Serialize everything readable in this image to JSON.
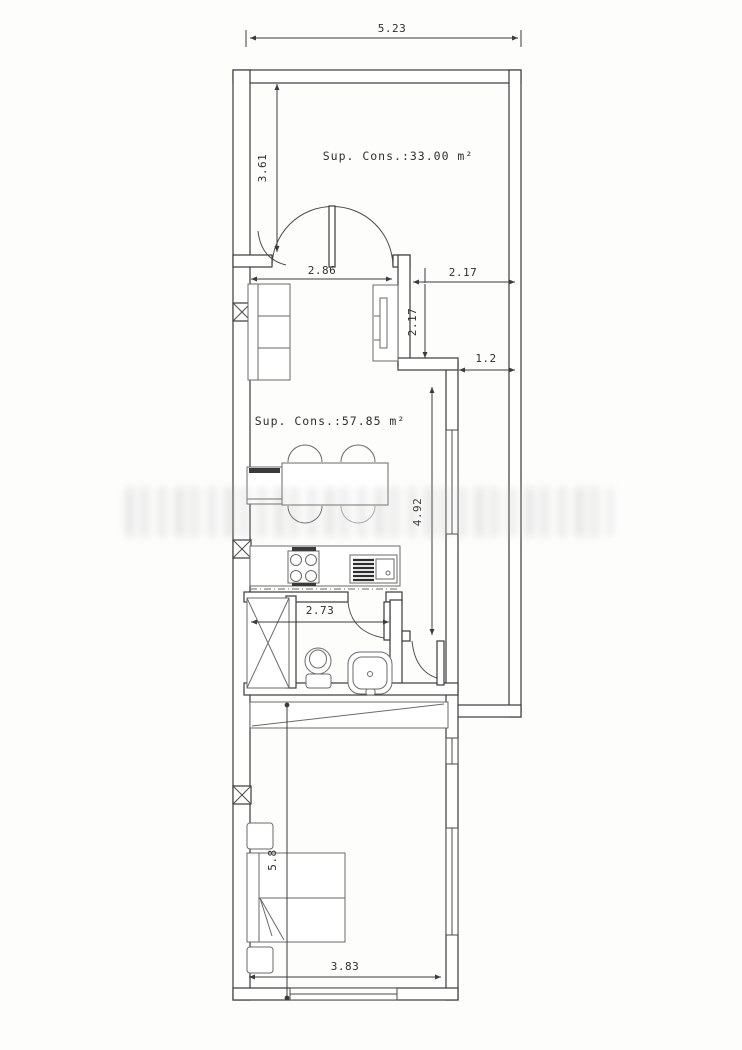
{
  "plan": {
    "type": "floor-plan",
    "areas": {
      "upper_room_label": "Sup. Cons.:33.00 m²",
      "living_room_label": "Sup. Cons.:57.85 m²"
    },
    "dimensions_m": {
      "total_width": "5.23",
      "upper_room_depth": "3.61",
      "living_opening_width": "2.86",
      "patio_width": "2.17",
      "patio_depth": "2.17",
      "side_passage_width": "1.2",
      "living_room_depth": "4.92",
      "bathroom_width": "2.73",
      "bedroom_depth": "5.8",
      "bedroom_width": "3.83"
    },
    "colors": {
      "wall_line": "#3a3a3a",
      "furniture_line": "#6a6a6a",
      "text": "#2f2f2f",
      "watermark": "#c0c0c0",
      "background": "#fdfdfc"
    }
  }
}
